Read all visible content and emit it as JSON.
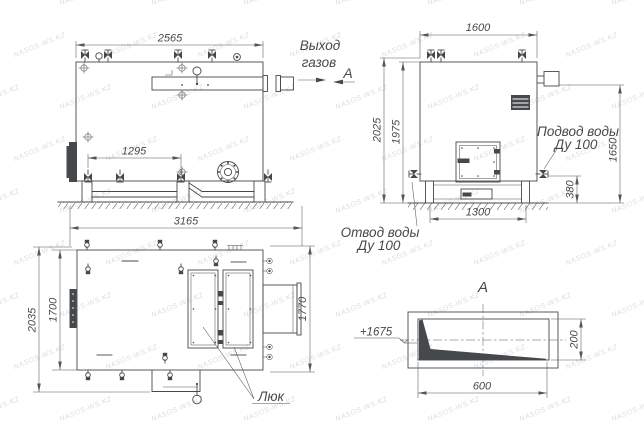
{
  "watermark": {
    "text": "NASOS-WS.KZ"
  },
  "labels": {
    "gas_outlet_line1": "Выход",
    "gas_outlet_line2": "газов",
    "section_arrow": "А",
    "section_title": "А",
    "water_inlet_line1": "Подвод воды",
    "water_inlet_line2": "Ду 100",
    "water_outlet_line1": "Отвод воды",
    "water_outlet_line2": "Ду 100",
    "hatch": "Люк",
    "elevation_mark": "+1675"
  },
  "dimensions": {
    "side_view": {
      "top_width": "2565",
      "valve_spacing": "1295",
      "overall_length": "3165"
    },
    "front_view": {
      "width": "1600",
      "overall_height": "2025",
      "body_height": "1975",
      "outlet_height": "1650",
      "drain_height": "380",
      "base_width": "1300"
    },
    "top_view": {
      "overall_width": "2035",
      "body_width": "1700",
      "right_width": "1770"
    },
    "section_a": {
      "duct_height": "200",
      "duct_width": "600"
    }
  },
  "colors": {
    "line": "#46494c",
    "dim_line": "#54575a",
    "watermark": "#b9c2c9",
    "background": "#ffffff"
  }
}
